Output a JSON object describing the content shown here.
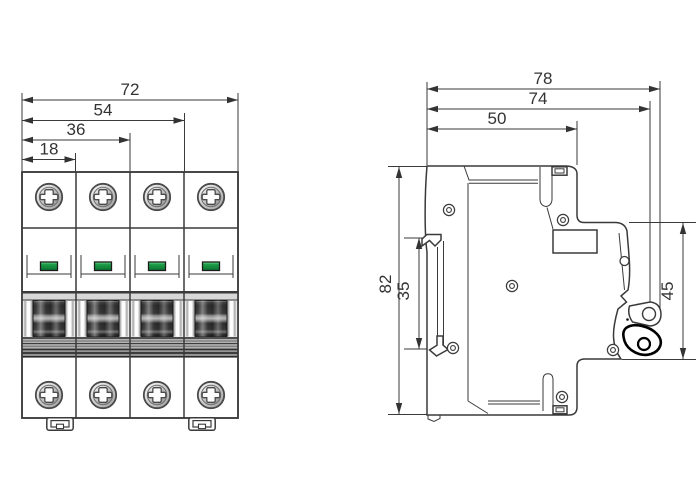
{
  "front_view": {
    "dims": {
      "w72": "72",
      "w54": "54",
      "w36": "36",
      "w18": "18"
    }
  },
  "side_view": {
    "dims": {
      "d78": "78",
      "d74": "74",
      "d50": "50",
      "h82": "82",
      "h35": "35",
      "h45": "45"
    }
  },
  "colors": {
    "line": "#3a3a3a",
    "indicator_green": "#11873a",
    "handle_dark": "#262626"
  }
}
